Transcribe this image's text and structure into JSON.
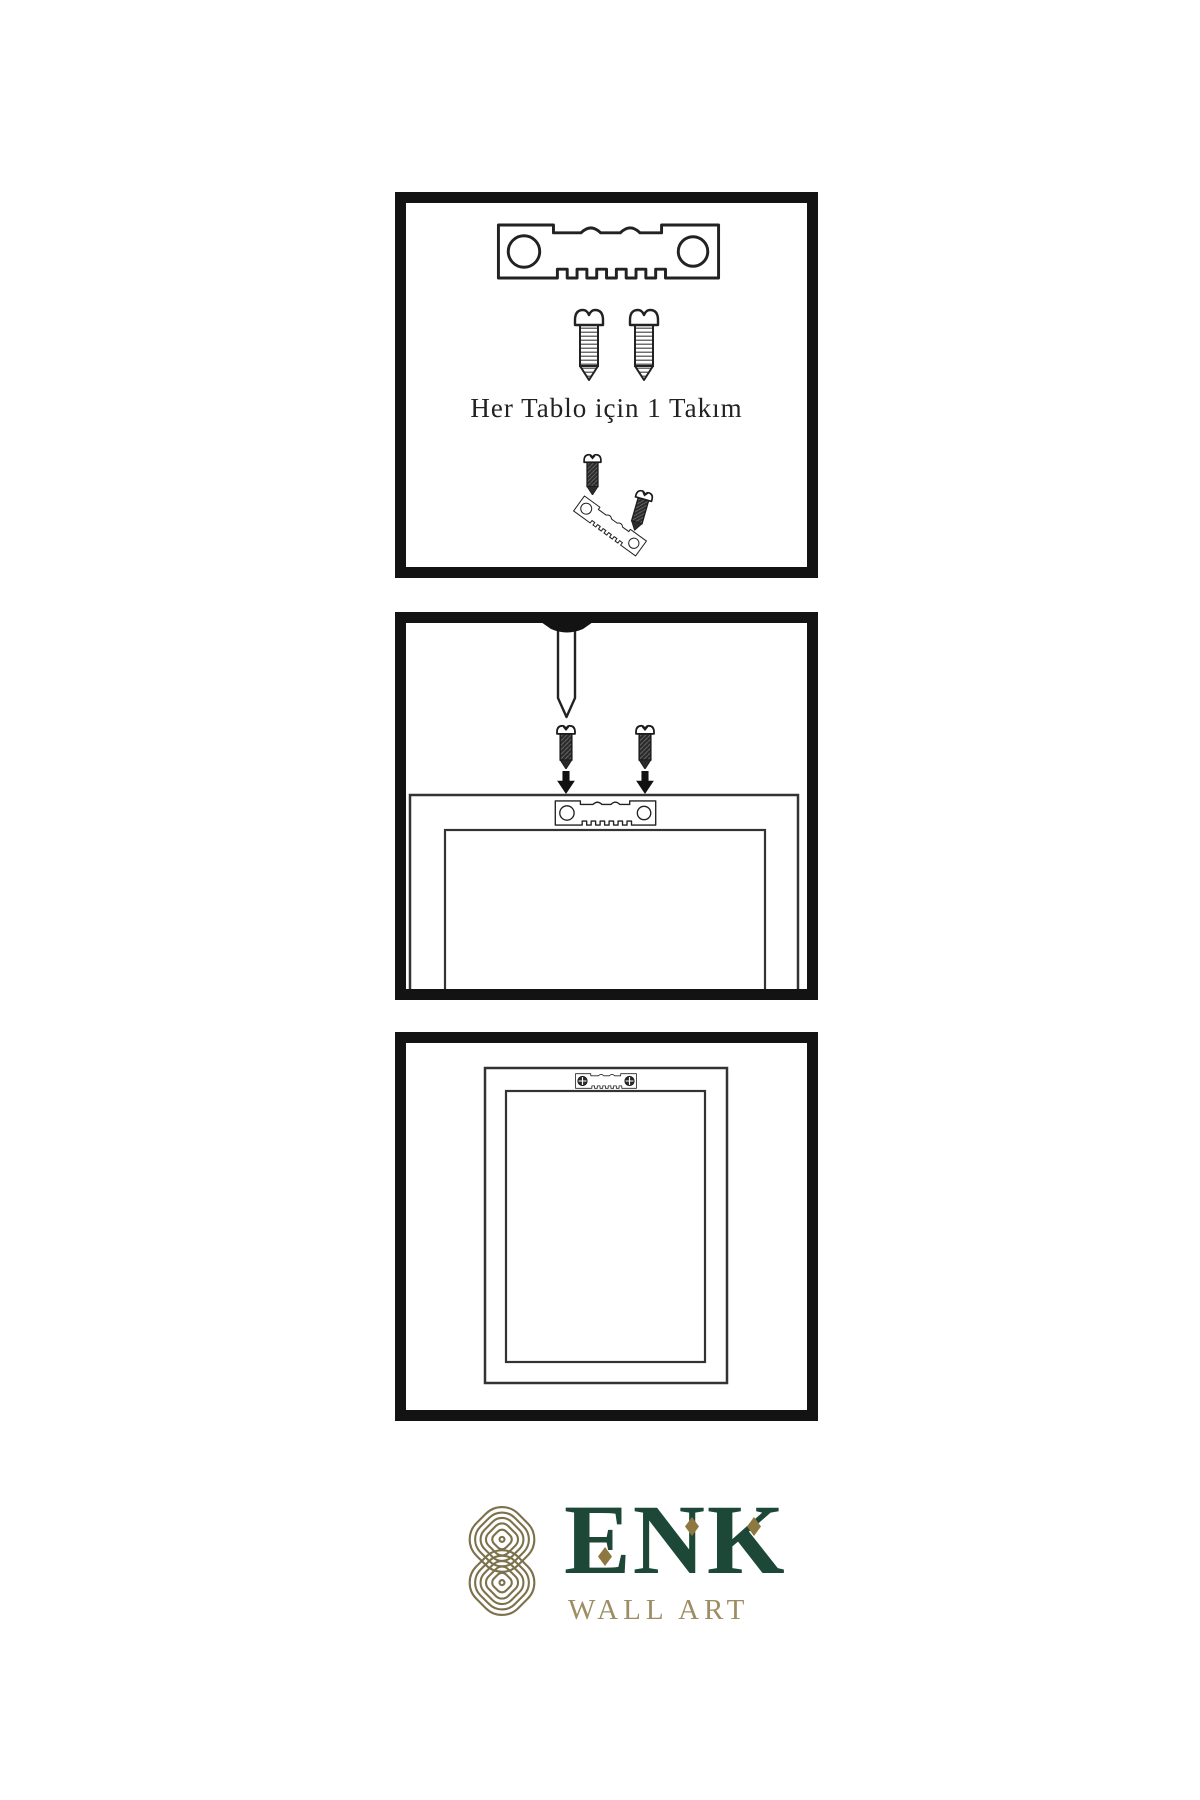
{
  "page": {
    "background_color": "#ffffff"
  },
  "colors": {
    "panel_border": "#131313",
    "line_art": "#222222",
    "dark_hardware": "#2b2b2b",
    "caption_text": "#222222",
    "logo_knot_gold": "#7d714c",
    "logo_brand_green": "#1d4737",
    "logo_diamond_gold": "#8d7840",
    "logo_subtitle_tan": "#9d8d62"
  },
  "panels": [
    {
      "name": "hardware-kit",
      "caption": "Her Tablo için 1 Takım",
      "icons": [
        "sawtooth-hanger-icon",
        "screw-icon",
        "screw-icon",
        "dark-screw-icon",
        "tilted-sawtooth-hanger-icon"
      ]
    },
    {
      "name": "wall-mounting",
      "icons": [
        "nail-icon",
        "dark-screw-icon",
        "dark-screw-icon",
        "down-arrow-icon",
        "down-arrow-icon",
        "frame-back-icon",
        "sawtooth-hanger-icon"
      ]
    },
    {
      "name": "frame-hung",
      "icons": [
        "frame-back-icon",
        "mounted-sawtooth-hanger-icon",
        "screw-head-icon",
        "screw-head-icon"
      ]
    }
  ],
  "logo": {
    "icon": "knot-icon",
    "brand": "ENK",
    "subtitle": "WALL ART"
  }
}
